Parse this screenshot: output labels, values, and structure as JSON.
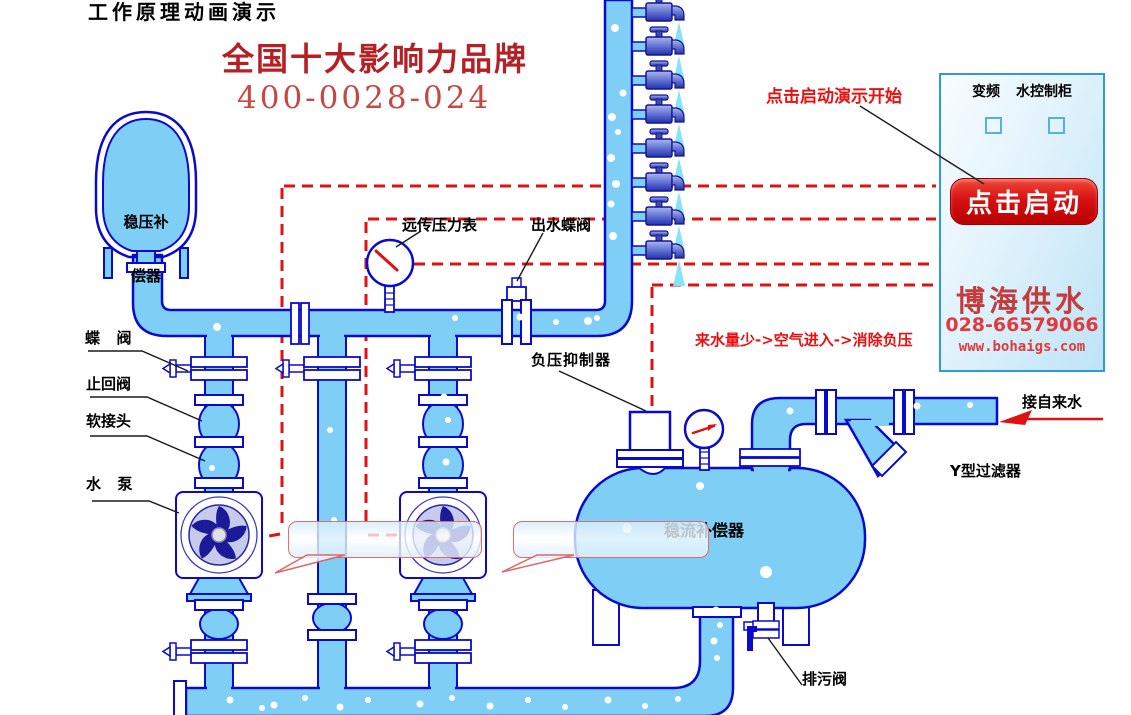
{
  "page": {
    "title": "工作原理动画演示"
  },
  "brand": {
    "slogan": "全国十大影响力品牌",
    "hotline": "400-0028-024"
  },
  "hints": {
    "start": "点击启动演示开始",
    "process": "来水量少->空气进入->消除负压"
  },
  "cabinet": {
    "label_left": "变频",
    "label_right": "水控制柜",
    "start_button": "点击启动",
    "company": "博海供水",
    "phone": "028-66579066",
    "website": "www.bohaigs.com"
  },
  "labels": {
    "surge_tank_line1": "稳压补",
    "surge_tank_line2": "偿器",
    "butterfly_valve": "蝶  阀",
    "check_valve": "止回阀",
    "soft_joint": "软接头",
    "pump": "水  泵",
    "remote_gauge": "远传压力表",
    "outlet_valve": "出水蝶阀",
    "vacuum_suppressor": "负压抑制器",
    "flow_tank": "稳流补偿器",
    "tap_water": "接自来水",
    "y_filter": "Y型过滤器",
    "drain_valve": "排污阀"
  },
  "colors": {
    "pipe_fill": "#7FCEF5",
    "pipe_stroke": "#0A0ACE",
    "dash_red": "#DE1212",
    "accent_red": "#E81111",
    "brand_red": "#B52025",
    "button_red": "#C40000",
    "cabinet_border": "#2E9BD6"
  }
}
